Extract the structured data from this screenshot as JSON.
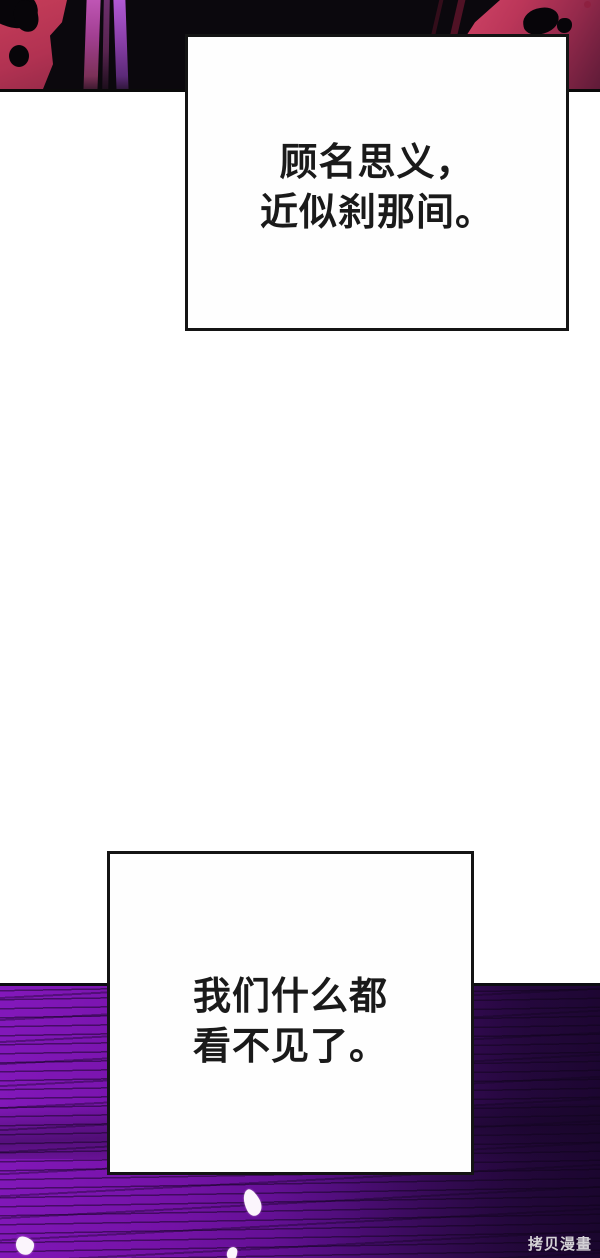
{
  "page": {
    "kind": "webtoon-comic-page",
    "background": "#ffffff"
  },
  "bubbles": {
    "first": {
      "line1": "顾名思义，",
      "line2": "近似刹那间。"
    },
    "second": {
      "line1": "我们什么都",
      "line2": "看不见了。"
    }
  },
  "watermark": {
    "text": "拷贝漫畫"
  },
  "colors": {
    "top_panel_red": "#bb3457",
    "top_panel_black": "#0b080d",
    "purple_speed_streak": "#a94fc4",
    "bottom_panel_purple": "#7313a8",
    "bottom_panel_dark": "#250840",
    "speech_box_border": "#141414",
    "dialogue_text": "#1a1a1a",
    "watermark_text": "#d4d2d6",
    "petal_white": "#fbf5fc"
  }
}
